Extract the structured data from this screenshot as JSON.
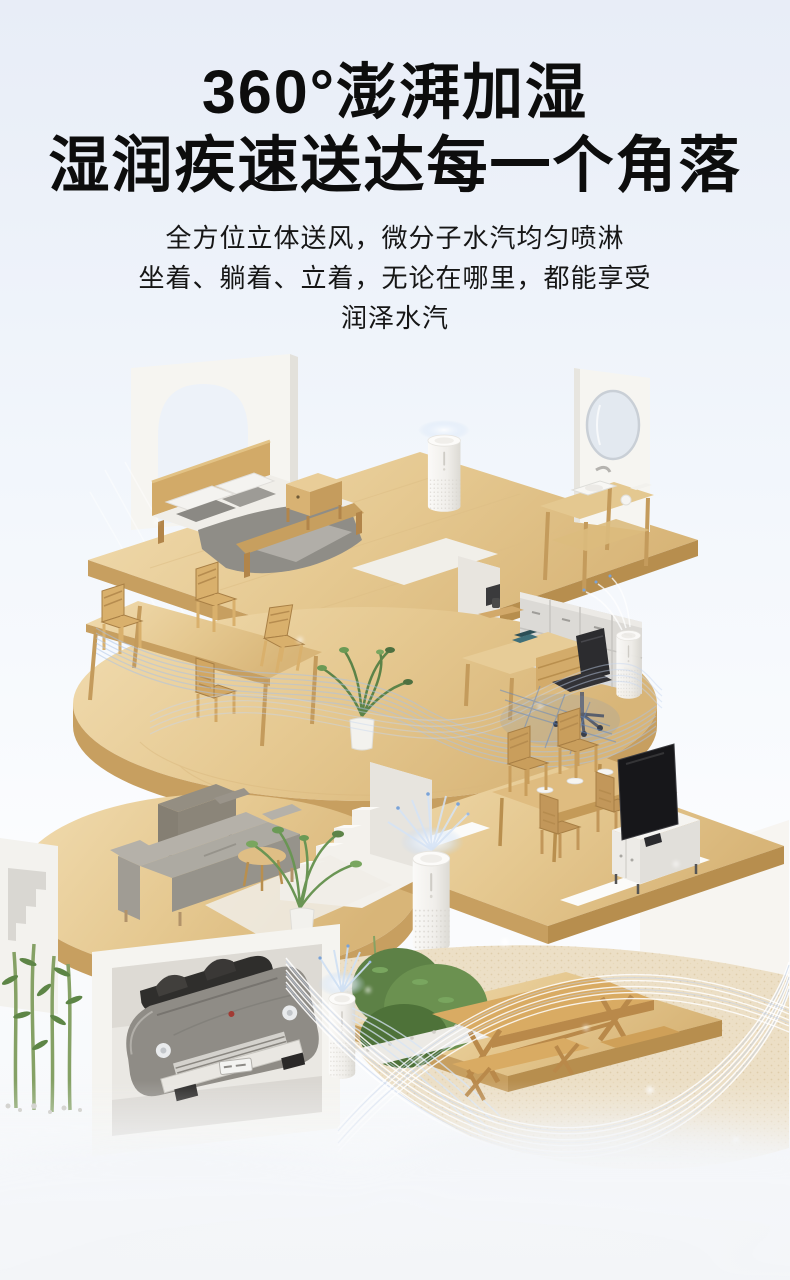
{
  "header": {
    "title_lines": [
      "360°澎湃加湿",
      "湿润疾速送达每一个角落"
    ],
    "subtitle_lines": [
      "全方位立体送风，微分子水汽均匀喷淋",
      "坐着、躺着、立着，无论在哪里，都能享受",
      "润泽水汽"
    ]
  },
  "illustration": {
    "scene": "three-storey-home-cutaway-with-humidifiers-and-mist",
    "floors": [
      {
        "name": "bedroom-and-bathroom",
        "items": [
          "arched-wall",
          "double-bed",
          "nightstand",
          "humidifier",
          "vanity-table",
          "round-mirror",
          "sink",
          "towels"
        ]
      },
      {
        "name": "dining-and-office",
        "items": [
          "long-dining-table",
          "wooden-chairs",
          "white-staircase",
          "potted-plant",
          "file-cabinets",
          "desk",
          "office-chair",
          "humidifier"
        ]
      },
      {
        "name": "living-room",
        "items": [
          "armchair",
          "sofa",
          "side-table",
          "palm-plant",
          "rug",
          "humidifier",
          "dining-set",
          "tv",
          "tv-cabinet",
          "white-staircase"
        ]
      },
      {
        "name": "garage-and-patio",
        "items": [
          "stair-wall",
          "bamboo-plants",
          "vintage-car",
          "humidifier",
          "garden-hedge",
          "picnic-table",
          "benches",
          "wood-deck"
        ]
      }
    ],
    "effects": [
      "mist-wave-mesh",
      "sparkle-dots",
      "mist-burst"
    ]
  },
  "colors": {
    "background_top": "#e8edf7",
    "background_bottom": "#f5f7f9",
    "title_text": "#0d0d0d",
    "body_text": "#161616",
    "wood_top": "#e8cd9a",
    "wood_side": "#c79f60",
    "wall_white": "#f5f4f0",
    "device_white": "#f7f6f3",
    "mist_blue": "#a9c2e8",
    "mist_deep_blue": "#5d85c4",
    "sofa_gray": "#b0aca4",
    "armchair_gray": "#8b8579",
    "plant_green": "#5d8146",
    "car_gray": "#8f8c86",
    "tv_black": "#17171a",
    "sand_floor": "#ecdfc6"
  }
}
